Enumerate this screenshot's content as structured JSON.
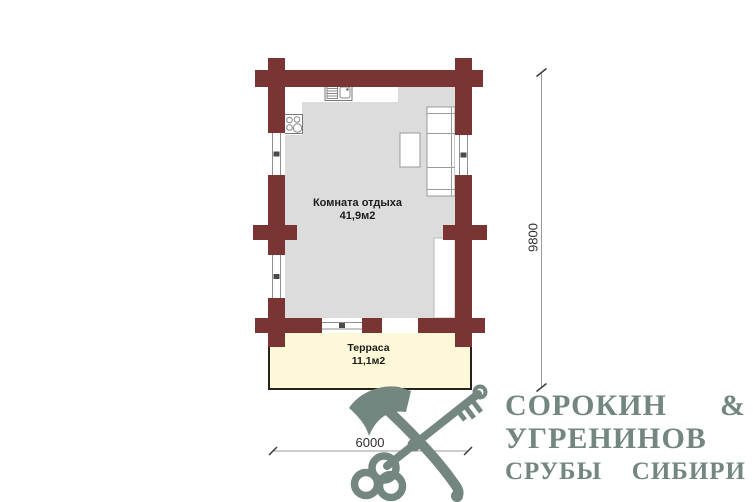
{
  "plan": {
    "room": {
      "label": "Комната отдыха",
      "area": "41,9м2"
    },
    "terrace": {
      "label": "Терраса",
      "area": "11,1м2"
    },
    "dimensions": {
      "depth": "9800",
      "width": "6000"
    }
  },
  "logo": {
    "line1": "СОРОКИН &",
    "line2": "УГРЕНИНОВ",
    "line3": "СРУБЫ СИБИРИ"
  },
  "icons": {
    "logo_icon": "crossed-axe-and-key"
  },
  "colors": {
    "wall": "#7b3434",
    "floor": "#dcdcdc",
    "terrace": "#fdf8d8",
    "logo": "#738780"
  }
}
